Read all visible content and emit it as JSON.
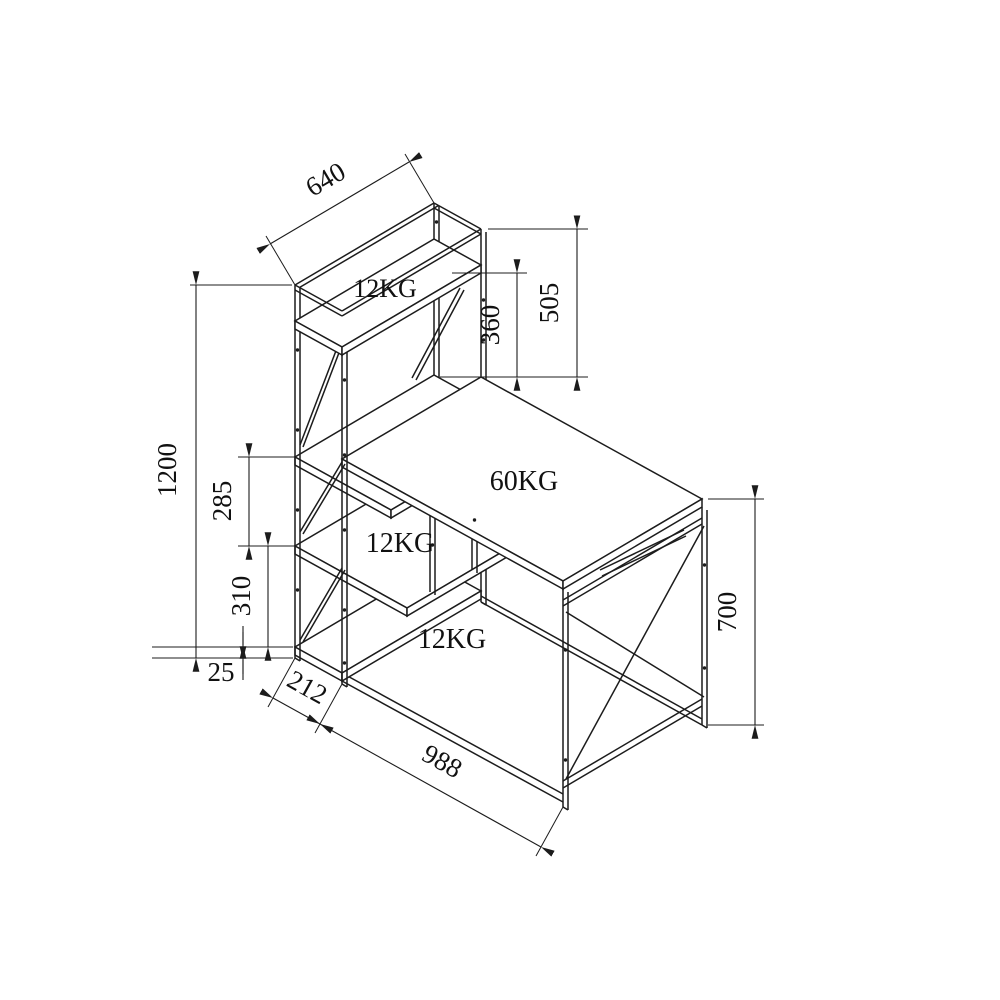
{
  "drawing": {
    "type": "technical-line-drawing",
    "subject": "computer desk with 4-tier side storage shelf tower",
    "background_color": "#ffffff",
    "line_color": "#1c1c1c",
    "dimensions": {
      "top_shelf_width": "640",
      "hutch_height": "505",
      "hutch_clearance": "360",
      "tower_height": "1200",
      "upper_shelf_gap": "285",
      "lower_shelf_gap": "310",
      "base_offset": "25",
      "tower_depth": "212",
      "desk_length": "988",
      "desk_leg_height": "700"
    },
    "load_labels": {
      "top_shelf": "12KG",
      "middle_shelf": "12KG",
      "bottom_shelf": "12KG",
      "desktop": "60KG"
    }
  }
}
